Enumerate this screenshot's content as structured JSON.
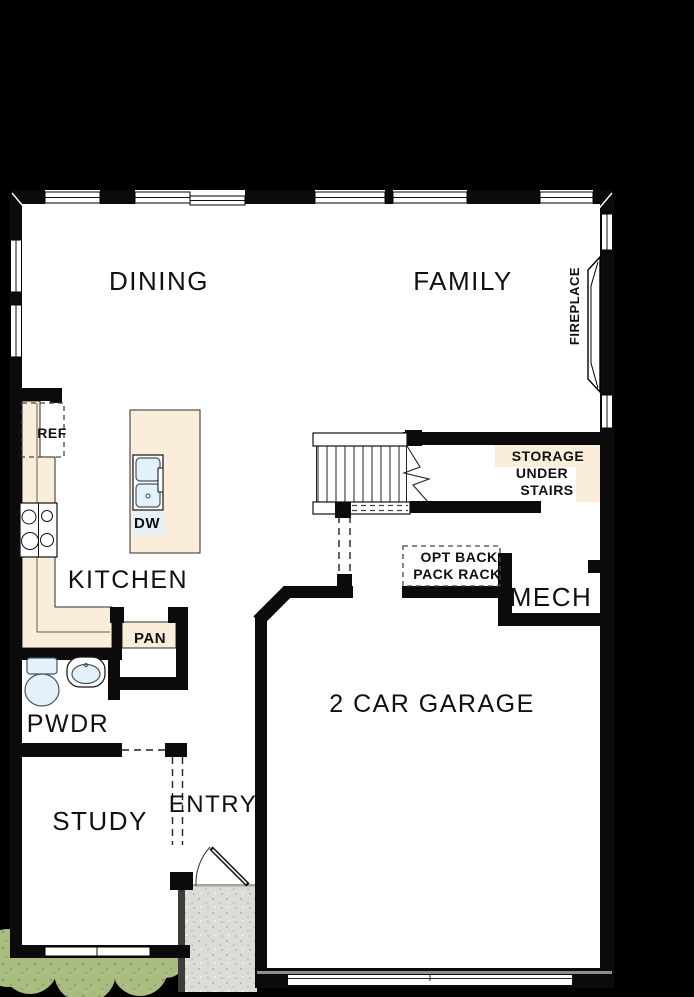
{
  "plan": {
    "rooms": {
      "dining": {
        "label": "DINING"
      },
      "family": {
        "label": "FAMILY"
      },
      "kitchen": {
        "label": "KITCHEN"
      },
      "powder": {
        "label": "PWDR"
      },
      "study": {
        "label": "STUDY"
      },
      "entry": {
        "label": "ENTRY"
      },
      "mech": {
        "label": "MECH"
      },
      "garage": {
        "label": "2 CAR GARAGE"
      }
    },
    "annotations": {
      "fireplace": {
        "label": "FIREPLACE"
      },
      "refrigerator": {
        "label": "REF"
      },
      "dishwasher": {
        "label": "DW"
      },
      "pantry": {
        "label": "PAN"
      },
      "storage": {
        "line1": "STORAGE",
        "line2": "UNDER",
        "line3": "STAIRS"
      },
      "opt_rack": {
        "line1": "OPT BACK",
        "line2": "PACK RACK"
      }
    },
    "colors": {
      "background": "#000000",
      "floor": "#ffffff",
      "wall": "#0b0b0b",
      "counter": "#faeedb",
      "fixture": "#e3f1fb",
      "porch": "#dcdcd6",
      "landscape": "#a9bd80",
      "label": "#101010"
    }
  }
}
